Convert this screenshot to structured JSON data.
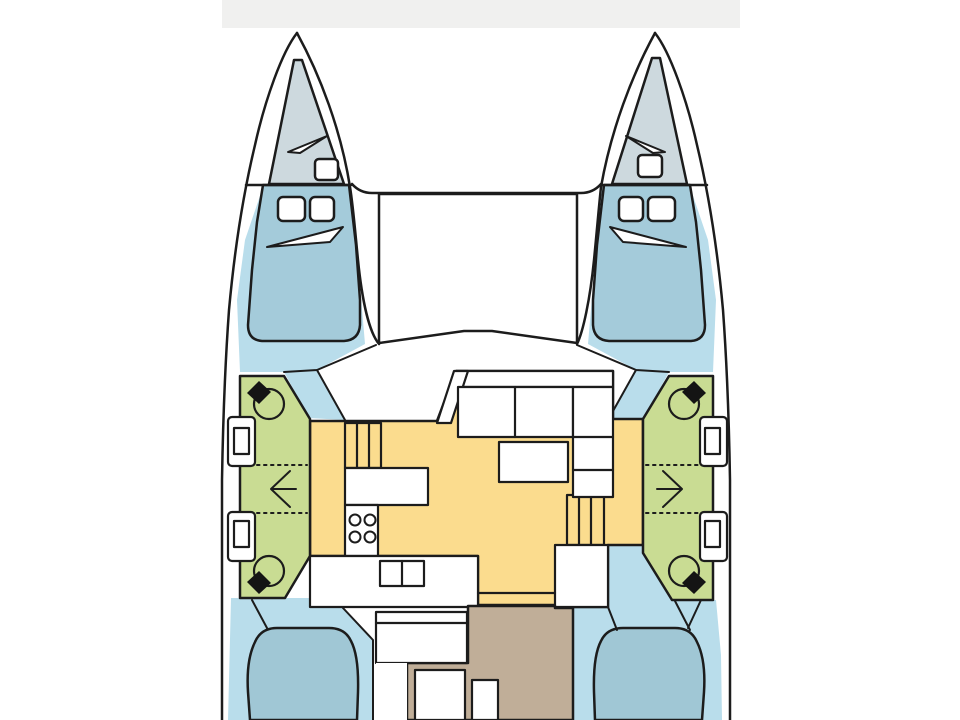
{
  "meta": {
    "description": "Top-down layout plan of a sailing catamaran: two hulls with forward and aft double berths, mid-hull heads with washbasins, central saloon with galley, sofa and table, bow trampoline and aft cockpit.",
    "text_visible": ""
  },
  "colors": {
    "outline": "#1c1c1c",
    "white": "#ffffff",
    "top_strip": "#f0f0ef",
    "deck_blue": "#b9ddeb",
    "cabin_blue": "#a4cbda",
    "berth_blue": "#a0c7d5",
    "forepeak_gray": "#cdd9de",
    "head_green": "#c9dc93",
    "saloon_yellow": "#fbdc8e",
    "cockpit_brown": "#c0ae98",
    "black_detail": "#141414"
  },
  "regions": {
    "port_hull": [
      "forepeak-locker",
      "fore-cabin-berth",
      "head-compartment",
      "aft-cabin-berth"
    ],
    "starboard_hull": [
      "forepeak-locker",
      "fore-cabin-berth",
      "head-compartment",
      "aft-cabin-berth"
    ],
    "center": [
      "trampoline",
      "mast-beam",
      "saloon",
      "galley",
      "sofa",
      "table",
      "cockpit"
    ]
  },
  "icons": {
    "washbasin": "circle with tap wedge",
    "stove": "four burner circles",
    "sink": "double basin",
    "companionway": "parallel step lines",
    "direction_arrows": [
      "left-arrow",
      "right-arrow"
    ]
  }
}
